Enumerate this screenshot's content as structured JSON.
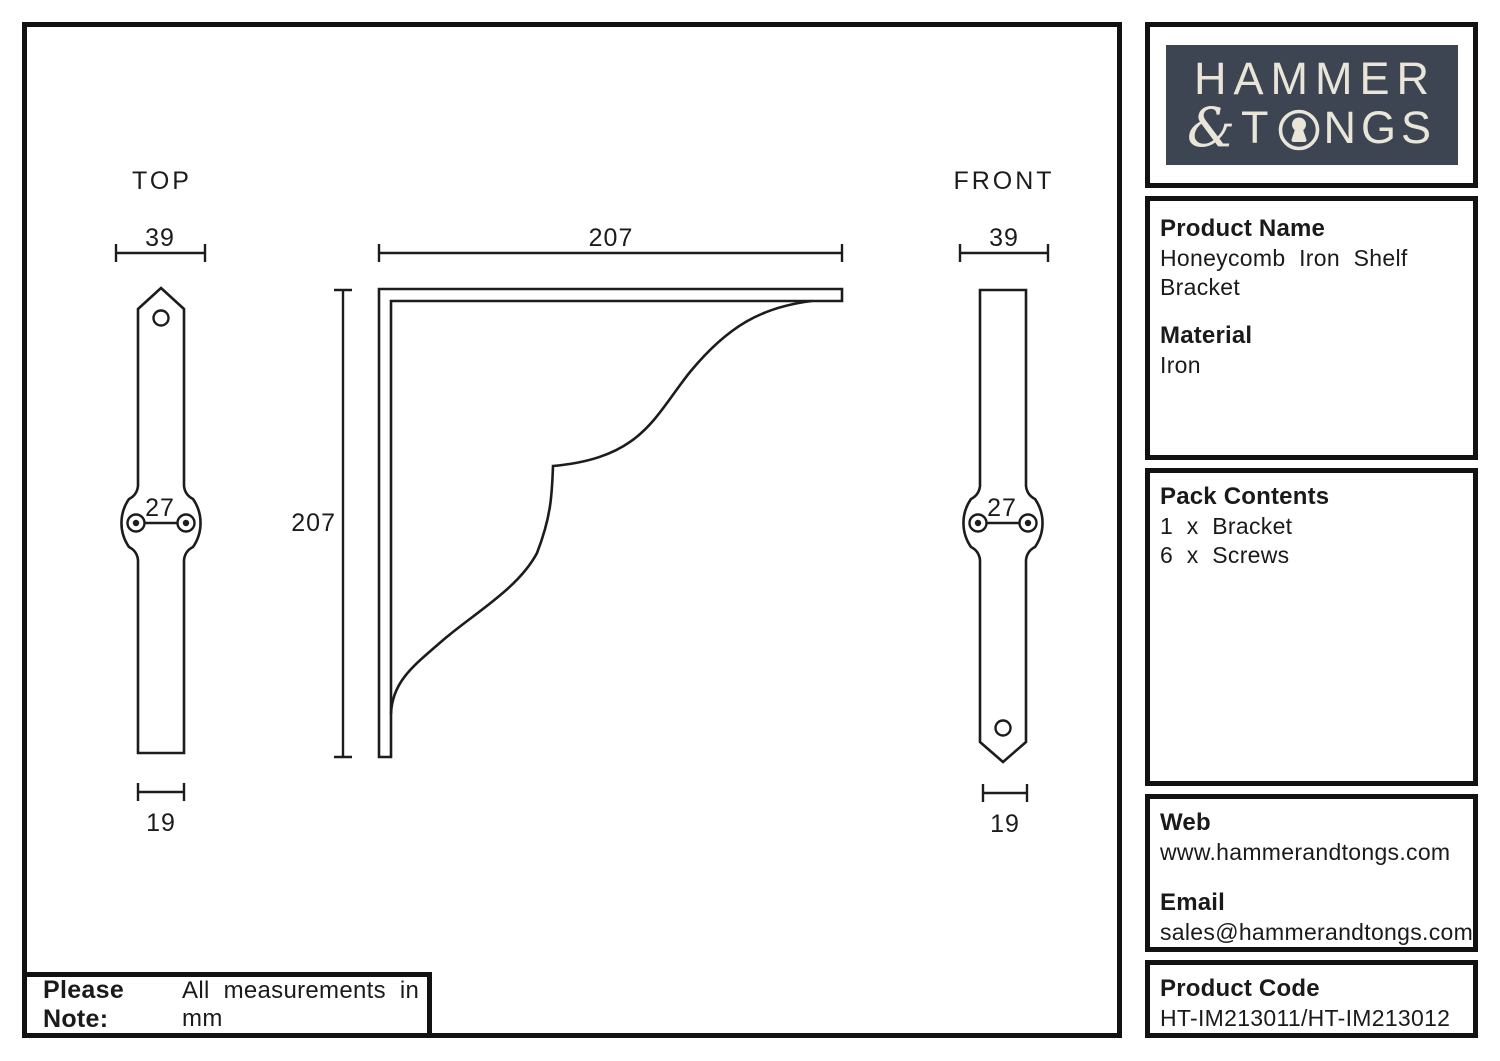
{
  "logo": {
    "line1": "HAMMER",
    "amp": "&",
    "t": "T",
    "ngs": "NGS"
  },
  "views": {
    "top": {
      "label": "TOP",
      "width_dim": "39",
      "hole_spacing_dim": "27",
      "base_dim": "19"
    },
    "front": {
      "label": "FRONT",
      "width_dim": "39",
      "hole_spacing_dim": "27",
      "base_dim": "19"
    },
    "side": {
      "width_dim": "207",
      "height_dim": "207"
    }
  },
  "panels": {
    "product": {
      "heading": "Product Name",
      "value": "Honeycomb Iron Shelf Bracket",
      "heading2": "Material",
      "value2": "Iron"
    },
    "pack": {
      "heading": "Pack Contents",
      "items": [
        "1 x Bracket",
        "6 x Screws"
      ]
    },
    "contact": {
      "web_heading": "Web",
      "web": "www.hammerandtongs.com",
      "email_heading": "Email",
      "email": "sales@hammerandtongs.com"
    },
    "code": {
      "heading": "Product Code",
      "value": "HT-IM213011/HT-IM213012"
    }
  },
  "note": {
    "bold": "Please Note:",
    "text": "All measurements in mm"
  },
  "colors": {
    "line": "#1c1c1c",
    "logo_bg": "#3d4452",
    "logo_fg": "#eae5d9"
  }
}
